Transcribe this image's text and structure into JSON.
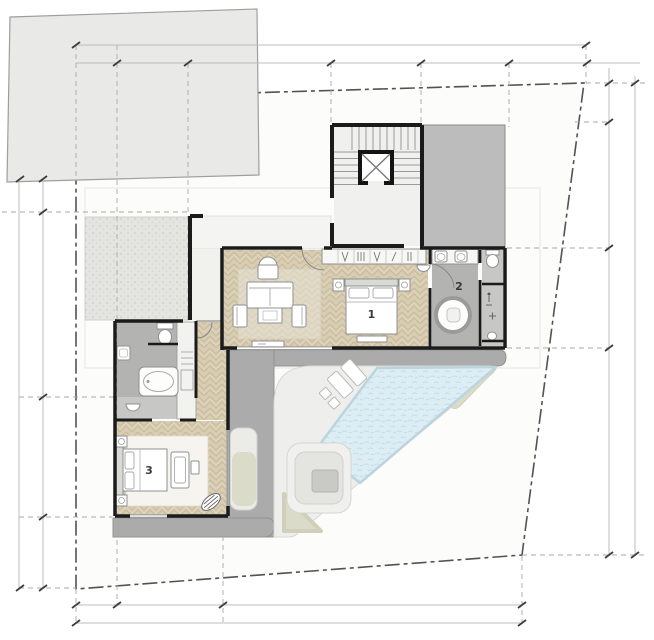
{
  "plan": {
    "type": "villa-floor-plan",
    "rooms": [
      {
        "id": "bedroom-1",
        "number": "1"
      },
      {
        "id": "bathroom-2",
        "number": "2"
      },
      {
        "id": "bedroom-3",
        "number": "3"
      }
    ]
  },
  "colors": {
    "wall": "#1b1b1b",
    "wood_floor": "#d8cdb2",
    "bath_floor": "#b3b3b1",
    "bath_floor_light": "#c7c7c5",
    "terrace": "#ababab",
    "pavement": "#eeeeec",
    "pool_water": "#dcedf3",
    "roof": "#bcbcbc",
    "neighbor_building": "#e9e9e7",
    "beige_landscape": "#dbdbc9",
    "boundary_line": "#525252",
    "dimension_line": "#b0b0b0"
  }
}
